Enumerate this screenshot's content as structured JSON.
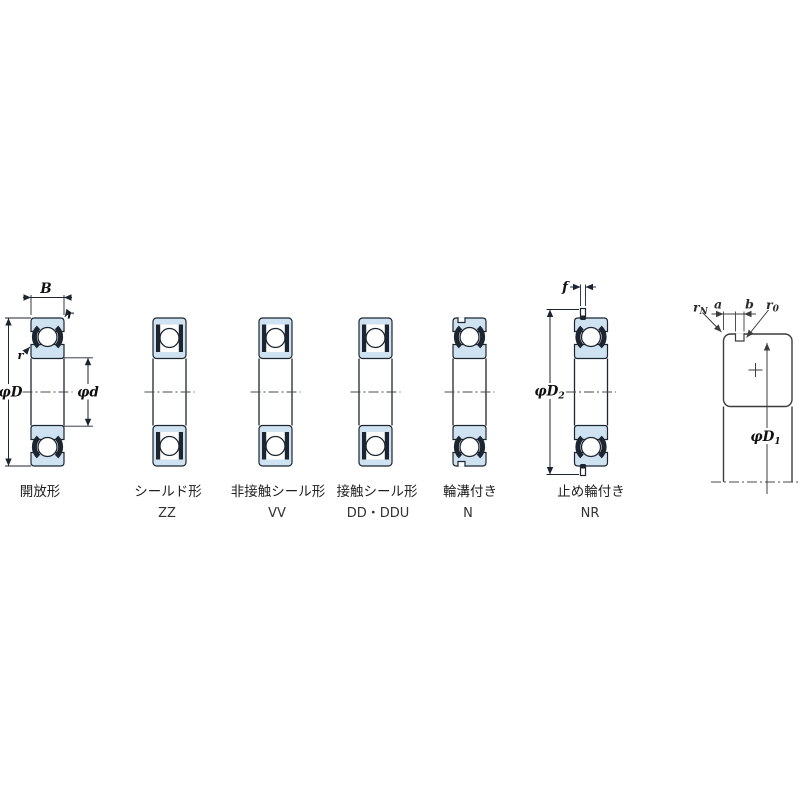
{
  "diagram": {
    "bearings": [
      {
        "label": "開放形",
        "code": ""
      },
      {
        "label": "シールド形",
        "code": "ZZ"
      },
      {
        "label": "非接触シール形",
        "code": "VV"
      },
      {
        "label": "接触シール形",
        "code": "DD・DDU"
      },
      {
        "label": "輪溝付き",
        "code": "N"
      },
      {
        "label": "止め輪付き",
        "code": "NR"
      }
    ],
    "dims": {
      "B": "B",
      "r": "r",
      "phiD": "φD",
      "phid": "φd",
      "f": "f",
      "phiD2": {
        "base": "φD",
        "sub": "2"
      },
      "phiD1": {
        "base": "φD",
        "sub": "1"
      },
      "rN": {
        "base": "r",
        "sub": "N"
      },
      "a": "a",
      "b": "b",
      "r0": {
        "base": "r",
        "sub": "0"
      }
    }
  },
  "colors": {
    "ring_fill": "#cfe2f1",
    "line": "#1c2530",
    "detail_line": "#3d3d3d"
  }
}
